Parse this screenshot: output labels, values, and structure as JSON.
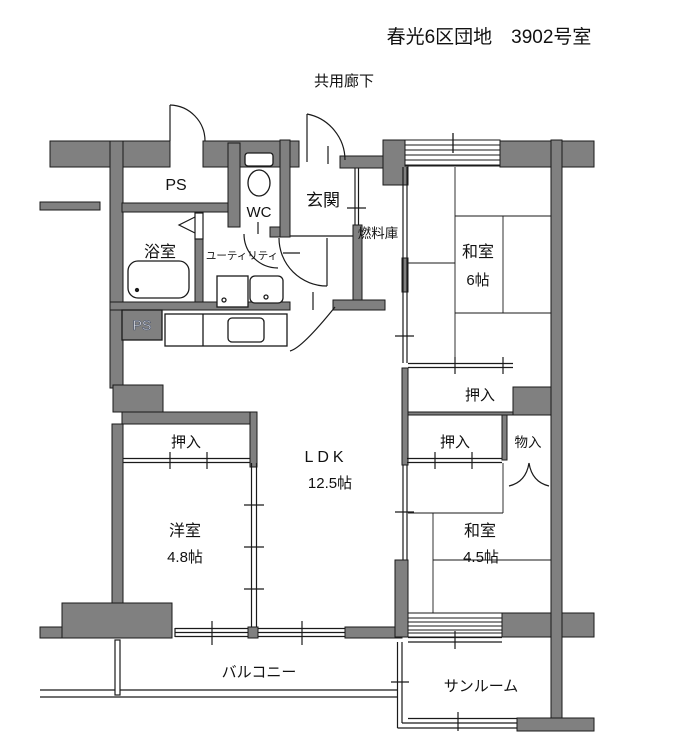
{
  "header": {
    "title": "春光6区団地　3902号室"
  },
  "plan": {
    "corridor_label": "共用廊下",
    "rooms": {
      "ps_top": {
        "label": "PS"
      },
      "wc": {
        "label": "WC"
      },
      "genkan": {
        "label": "玄関"
      },
      "fuel_storage": {
        "label": "燃料庫"
      },
      "washitsu_6": {
        "label": "和室",
        "size": "6帖"
      },
      "bathroom": {
        "label": "浴室"
      },
      "utility": {
        "label": "ユーティリティ"
      },
      "ps_mid": {
        "label": "PS"
      },
      "oshiire_west": {
        "label": "押入"
      },
      "ldk": {
        "label": "LDK",
        "size": "12.5帖"
      },
      "oshiire_north": {
        "label": "押入"
      },
      "oshiire_south": {
        "label": "押入"
      },
      "monoire": {
        "label": "物入"
      },
      "yoshitsu": {
        "label": "洋室",
        "size": "4.8帖"
      },
      "washitsu_45": {
        "label": "和室",
        "size": "4.5帖"
      },
      "balcony": {
        "label": "バルコニー"
      },
      "sunroom": {
        "label": "サンルーム"
      }
    }
  },
  "colors": {
    "wall": "#808080",
    "line": "#1a1a1a",
    "text": "#111111",
    "background": "#ffffff"
  }
}
